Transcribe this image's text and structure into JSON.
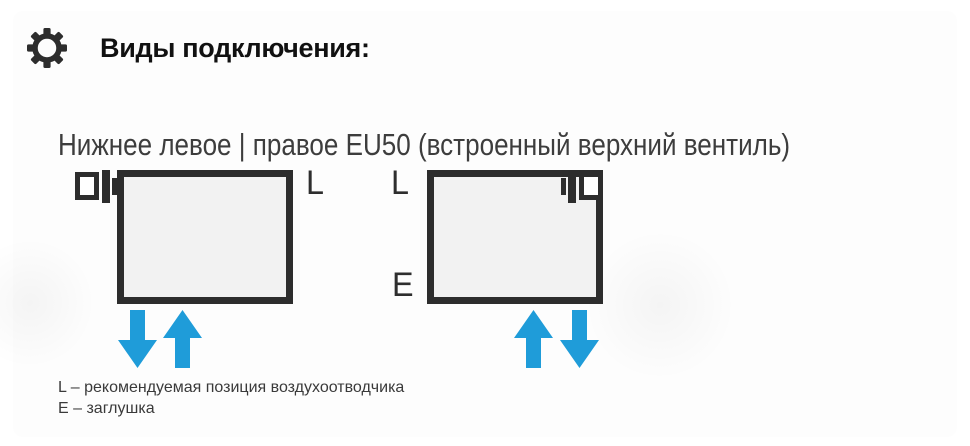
{
  "panel": {
    "title": "Виды подключения:",
    "title_icon": "gear-icon",
    "subtitle": "Нижнее левое | правое EU50 (встроенный верхний вентиль)"
  },
  "diagrams": [
    {
      "name": "bottom-left-connection",
      "valve_side": "top-left",
      "valve_icon": "air-vent-valve-icon",
      "labels": {
        "top_right": "L"
      },
      "arrows": [
        "down",
        "up"
      ]
    },
    {
      "name": "bottom-right-connection",
      "valve_side": "top-right",
      "valve_icon": "air-vent-valve-icon",
      "labels": {
        "top_left": "L",
        "bottom_left": "E"
      },
      "arrows": [
        "up",
        "down"
      ]
    }
  ],
  "legend": {
    "lines": [
      "L – рекомендуемая позиция воздухоотводчика",
      "E – заглушка"
    ]
  },
  "colors": {
    "outline_dark": "#2d2d2d",
    "radiator_fill": "#f2f2f2",
    "arrow_blue": "#1f9cd9",
    "text_primary": "#111111",
    "text_secondary": "#3d3d3d"
  }
}
